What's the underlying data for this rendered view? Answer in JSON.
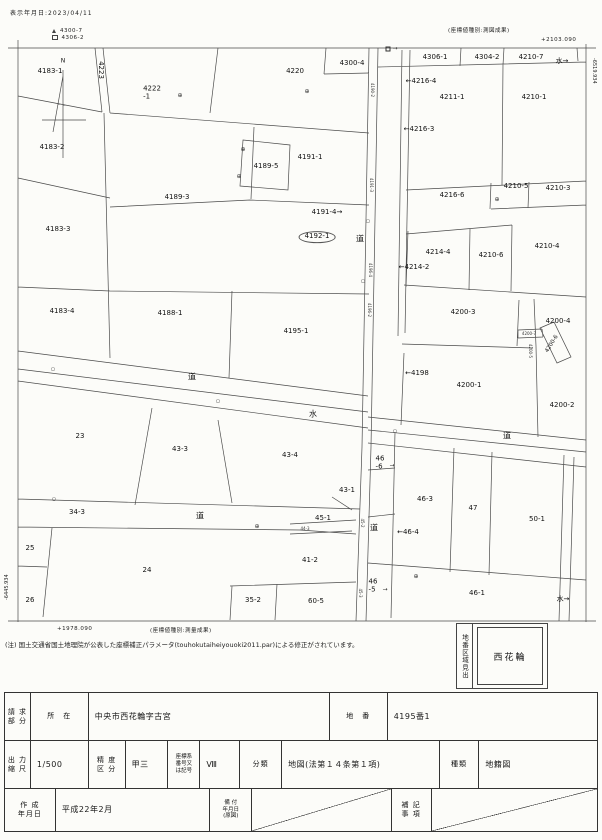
{
  "header": {
    "display_date": "表示年月日:2023/04/11",
    "coord_type_top": "(座標値種別:測図成果)",
    "coord_top_right": "+2103.090"
  },
  "legend": [
    {
      "marker": "triangle",
      "label": "4300-7"
    },
    {
      "marker": "square",
      "label": "4306-2"
    }
  ],
  "edges": {
    "right_edge_coord": "-6519.934",
    "left_edge_coord": "-6445.934",
    "bottom_left_coord": "+1978.090",
    "coord_type_bottom": "(座標値種別:測量成果)"
  },
  "note": "(注) 国土交通省国土地理院が公表した座標補正パラメータ(touhokutaiheiyouoki2011.par)による修正がされています。",
  "index_box": {
    "title": "地番区域見出",
    "value": "西花輪"
  },
  "map": {
    "labels": [
      {
        "text": "N",
        "x": 63,
        "y": 62,
        "cls": "small"
      },
      {
        "text": "4183-1",
        "x": 50,
        "y": 72
      },
      {
        "text": "4223",
        "x": 100,
        "y": 70,
        "cls": "v"
      },
      {
        "text": "4222\n-1",
        "x": 152,
        "y": 93,
        "cls": "two"
      },
      {
        "text": "4220",
        "x": 295,
        "y": 72
      },
      {
        "text": "4300-4",
        "x": 352,
        "y": 64
      },
      {
        "text": "4306-1",
        "x": 435,
        "y": 58
      },
      {
        "text": "4304-2",
        "x": 487,
        "y": 58
      },
      {
        "text": "4210-7",
        "x": 531,
        "y": 58
      },
      {
        "text": "水→",
        "x": 562,
        "y": 62
      },
      {
        "text": "←4216-4",
        "x": 421,
        "y": 82
      },
      {
        "text": "4211-1",
        "x": 452,
        "y": 98
      },
      {
        "text": "4210-1",
        "x": 534,
        "y": 98
      },
      {
        "text": "←4216-3",
        "x": 419,
        "y": 130
      },
      {
        "text": "4183-2",
        "x": 52,
        "y": 148
      },
      {
        "text": "4191-1",
        "x": 310,
        "y": 158
      },
      {
        "text": "4189-5",
        "x": 266,
        "y": 167
      },
      {
        "text": "4189-3",
        "x": 177,
        "y": 198
      },
      {
        "text": "4216-6",
        "x": 452,
        "y": 196
      },
      {
        "text": "4210-5",
        "x": 516,
        "y": 187
      },
      {
        "text": "4210-3",
        "x": 558,
        "y": 189
      },
      {
        "text": "4191-4→",
        "x": 327,
        "y": 213
      },
      {
        "text": "4192-1",
        "x": 317,
        "y": 237,
        "cls": "ellipse"
      },
      {
        "text": "道",
        "x": 360,
        "y": 240,
        "cls": "road"
      },
      {
        "text": "4183-3",
        "x": 58,
        "y": 230
      },
      {
        "text": "4214-4",
        "x": 438,
        "y": 253
      },
      {
        "text": "←4214-2",
        "x": 414,
        "y": 268
      },
      {
        "text": "4210-6",
        "x": 491,
        "y": 256
      },
      {
        "text": "4210-4",
        "x": 547,
        "y": 247
      },
      {
        "text": "4183-4",
        "x": 62,
        "y": 312
      },
      {
        "text": "4188-1",
        "x": 170,
        "y": 314
      },
      {
        "text": "4195-1",
        "x": 296,
        "y": 332
      },
      {
        "text": "4200-3",
        "x": 463,
        "y": 313
      },
      {
        "text": "4200-4",
        "x": 558,
        "y": 322
      },
      {
        "text": "4200-6",
        "x": 552,
        "y": 344,
        "cls": "rot"
      },
      {
        "text": "4200-5",
        "x": 530,
        "y": 351,
        "cls": "vt"
      },
      {
        "text": "4200-7",
        "x": 529,
        "y": 334,
        "cls": "tiny"
      },
      {
        "text": "←4198",
        "x": 417,
        "y": 374
      },
      {
        "text": "4200-1",
        "x": 469,
        "y": 386
      },
      {
        "text": "4200-2",
        "x": 562,
        "y": 406
      },
      {
        "text": "道",
        "x": 192,
        "y": 378,
        "cls": "road"
      },
      {
        "text": "水",
        "x": 313,
        "y": 415,
        "cls": "road"
      },
      {
        "text": "道",
        "x": 507,
        "y": 437,
        "cls": "road"
      },
      {
        "text": "23",
        "x": 80,
        "y": 437
      },
      {
        "text": "43-3",
        "x": 180,
        "y": 450
      },
      {
        "text": "43-4",
        "x": 290,
        "y": 456
      },
      {
        "text": "46\n-6",
        "x": 380,
        "y": 463,
        "cls": "two"
      },
      {
        "text": "34-3",
        "x": 77,
        "y": 513
      },
      {
        "text": "道",
        "x": 200,
        "y": 517,
        "cls": "road"
      },
      {
        "text": "45-1",
        "x": 323,
        "y": 519
      },
      {
        "text": "43-1",
        "x": 347,
        "y": 491
      },
      {
        "text": "道",
        "x": 374,
        "y": 529,
        "cls": "road"
      },
      {
        "text": "46-3",
        "x": 425,
        "y": 500
      },
      {
        "text": "47",
        "x": 473,
        "y": 509
      },
      {
        "text": "50-1",
        "x": 537,
        "y": 520
      },
      {
        "text": "←46-4",
        "x": 408,
        "y": 533
      },
      {
        "text": "25",
        "x": 30,
        "y": 549
      },
      {
        "text": "24",
        "x": 147,
        "y": 571
      },
      {
        "text": "41-2",
        "x": 310,
        "y": 561
      },
      {
        "text": "26",
        "x": 30,
        "y": 601
      },
      {
        "text": "35-2",
        "x": 253,
        "y": 601
      },
      {
        "text": "60-5",
        "x": 316,
        "y": 602
      },
      {
        "text": "46\n-5",
        "x": 373,
        "y": 586,
        "cls": "two"
      },
      {
        "text": "46-1",
        "x": 477,
        "y": 594
      },
      {
        "text": "水→",
        "x": 563,
        "y": 600
      },
      {
        "text": "44-3",
        "x": 305,
        "y": 529,
        "cls": "tiny"
      },
      {
        "text": "4190-2",
        "x": 372,
        "y": 90,
        "cls": "vt"
      },
      {
        "text": "4191-3",
        "x": 371,
        "y": 185,
        "cls": "vt"
      },
      {
        "text": "4196-4",
        "x": 370,
        "y": 270,
        "cls": "vt"
      },
      {
        "text": "4196-2",
        "x": 369,
        "y": 310,
        "cls": "vt"
      },
      {
        "text": "45-2",
        "x": 362,
        "y": 523,
        "cls": "vt"
      },
      {
        "text": "45-3",
        "x": 360,
        "y": 593,
        "cls": "vt"
      }
    ],
    "markers": [
      {
        "type": "oplus",
        "x": 180,
        "y": 96
      },
      {
        "type": "oplus",
        "x": 307,
        "y": 92
      },
      {
        "type": "oplus",
        "x": 243,
        "y": 150
      },
      {
        "type": "oplus",
        "x": 239,
        "y": 177
      },
      {
        "type": "oplus",
        "x": 497,
        "y": 200
      },
      {
        "type": "oplus",
        "x": 257,
        "y": 527
      },
      {
        "type": "oplus",
        "x": 416,
        "y": 577
      },
      {
        "type": "circ",
        "x": 53,
        "y": 370
      },
      {
        "type": "circ",
        "x": 54,
        "y": 500
      },
      {
        "type": "circ",
        "x": 218,
        "y": 402
      },
      {
        "type": "circ",
        "x": 368,
        "y": 222
      },
      {
        "type": "circ",
        "x": 363,
        "y": 282
      },
      {
        "type": "circ",
        "x": 395,
        "y": 432
      },
      {
        "type": "sq",
        "x": 388,
        "y": 49
      },
      {
        "type": "arrow",
        "x": 395,
        "y": 49
      },
      {
        "type": "arrow",
        "x": 392,
        "y": 466
      },
      {
        "type": "arrow",
        "x": 385,
        "y": 590
      }
    ]
  },
  "form": {
    "request_part_label": "請 求\n部 分",
    "location_label": "所　在",
    "location_value": "中央市西花輪字古宮",
    "parcel_label": "地　番",
    "parcel_value": "4195番1",
    "scale_label": "出 力\n縮 尺",
    "scale_value": "1/500",
    "accuracy_label": "精 度\n区 分",
    "accuracy_value": "甲三",
    "coord_sys_label": "座標系\n番号又\nは記号",
    "coord_sys_value": "Ⅷ",
    "class_label": "分類",
    "class_value": "地図(法第１４条第１項)",
    "kind_label": "種類",
    "kind_value": "地籍図",
    "created_label": "作 成\n年月日",
    "created_value": "平成22年2月",
    "filed_label": "備 付\n年月日\n(原図)",
    "remarks_label": "補 記\n事 項"
  }
}
